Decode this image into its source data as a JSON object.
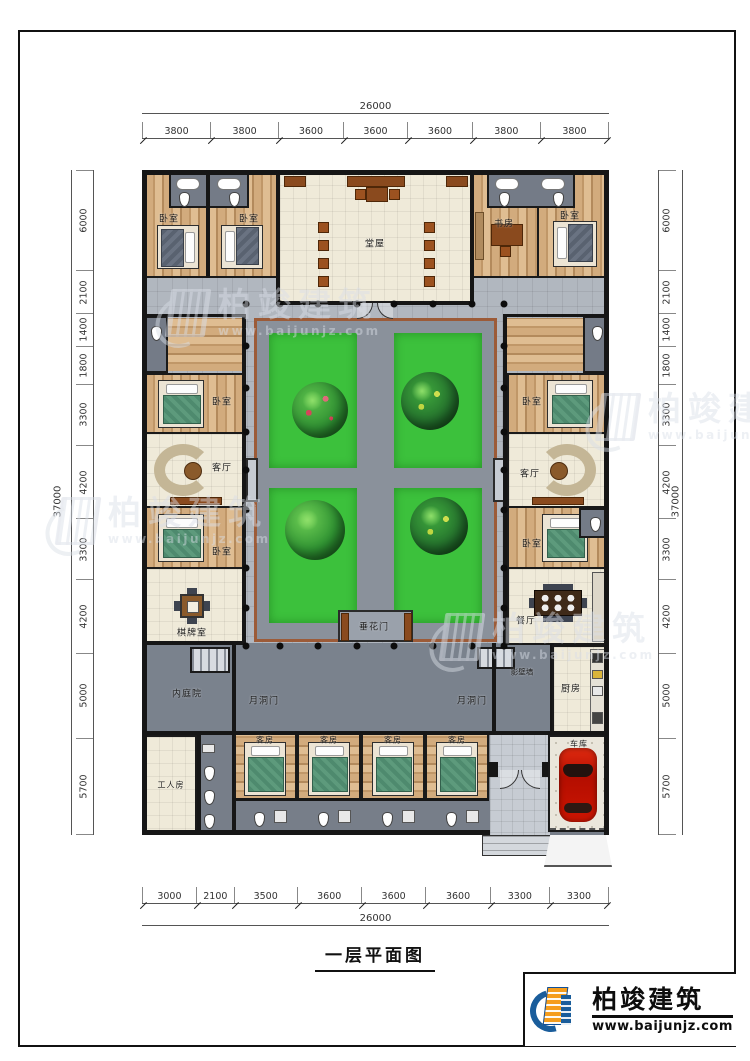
{
  "drawing": {
    "title": "一层平面图",
    "brand": "柏竣建筑",
    "brand_url": "www.baijunjz.com"
  },
  "dimensions": {
    "top": {
      "total": "26000",
      "segments": [
        "3800",
        "3800",
        "3600",
        "3600",
        "3600",
        "3800",
        "3800"
      ]
    },
    "bottom": {
      "total": "26000",
      "segments": [
        "3000",
        "2100",
        "3500",
        "3600",
        "3600",
        "3600",
        "3300",
        "3300"
      ]
    },
    "left": {
      "total": "37000",
      "segments": [
        "6000",
        "2100",
        "1400",
        "1800",
        "3300",
        "4200",
        "3300",
        "4200",
        "5000",
        "5700"
      ]
    },
    "right": {
      "total": "37000",
      "segments": [
        "6000",
        "2100",
        "1400",
        "1800",
        "3300",
        "4200",
        "3300",
        "4200",
        "5000",
        "5700"
      ]
    }
  },
  "rooms": {
    "bedroom": "卧室",
    "hall": "堂屋",
    "study": "书房",
    "living_room": "客厅",
    "mahjong_room": "棋牌室",
    "dining_room": "餐厅",
    "inner_courtyard": "内庭院",
    "moon_gate": "月洞门",
    "screen_wall": "影壁墙",
    "kitchen": "厨房",
    "flower_gate": "垂花门",
    "worker_room": "工人房",
    "guest_room": "客房",
    "garage": "车库"
  },
  "colors": {
    "lawn": "#3cc13c",
    "wood": "#c9a476",
    "veranda": "#b1b7bf",
    "passage": "#7a828d",
    "car": "#c41001",
    "courtyard_border": "#9c5b38",
    "logo_blue": "#1a5d9b",
    "logo_orange": "#f59d1d"
  }
}
